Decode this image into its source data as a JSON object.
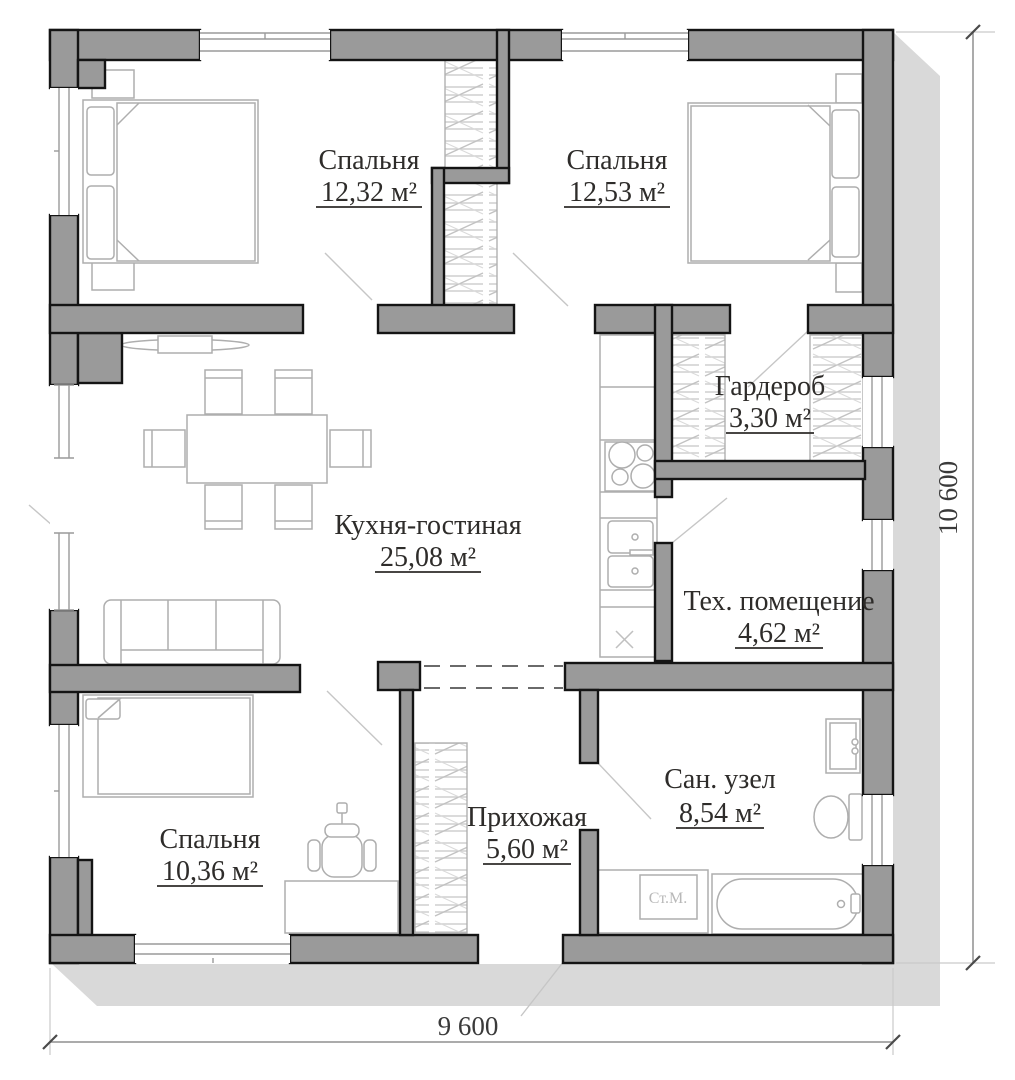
{
  "rooms": [
    {
      "name": "Спальня",
      "area": "12,32 м²"
    },
    {
      "name": "Спальня",
      "area": "12,53 м²"
    },
    {
      "name": "Гардероб",
      "area": "3,30 м²"
    },
    {
      "name": "Кухня-гостиная",
      "area": "25,08 м²"
    },
    {
      "name": "Тех. помещение",
      "area": "4,62 м²"
    },
    {
      "name": "Сан. узел",
      "area": "8,54 м²"
    },
    {
      "name": "Прихожая",
      "area": "5,60 м²"
    },
    {
      "name": "Спальня",
      "area": "10,36 м²"
    }
  ],
  "dimensions": {
    "bottom": "9 600",
    "right": "10 600"
  },
  "appliances": {
    "washing_machine_label": "Ст.М."
  },
  "colors": {
    "wall_fill": "#9a9a9a",
    "wall_outline": "#141414",
    "shadow": "#d9d9d9",
    "furniture_line": "#b0b0b0",
    "label_text": "#2e2c2a"
  }
}
